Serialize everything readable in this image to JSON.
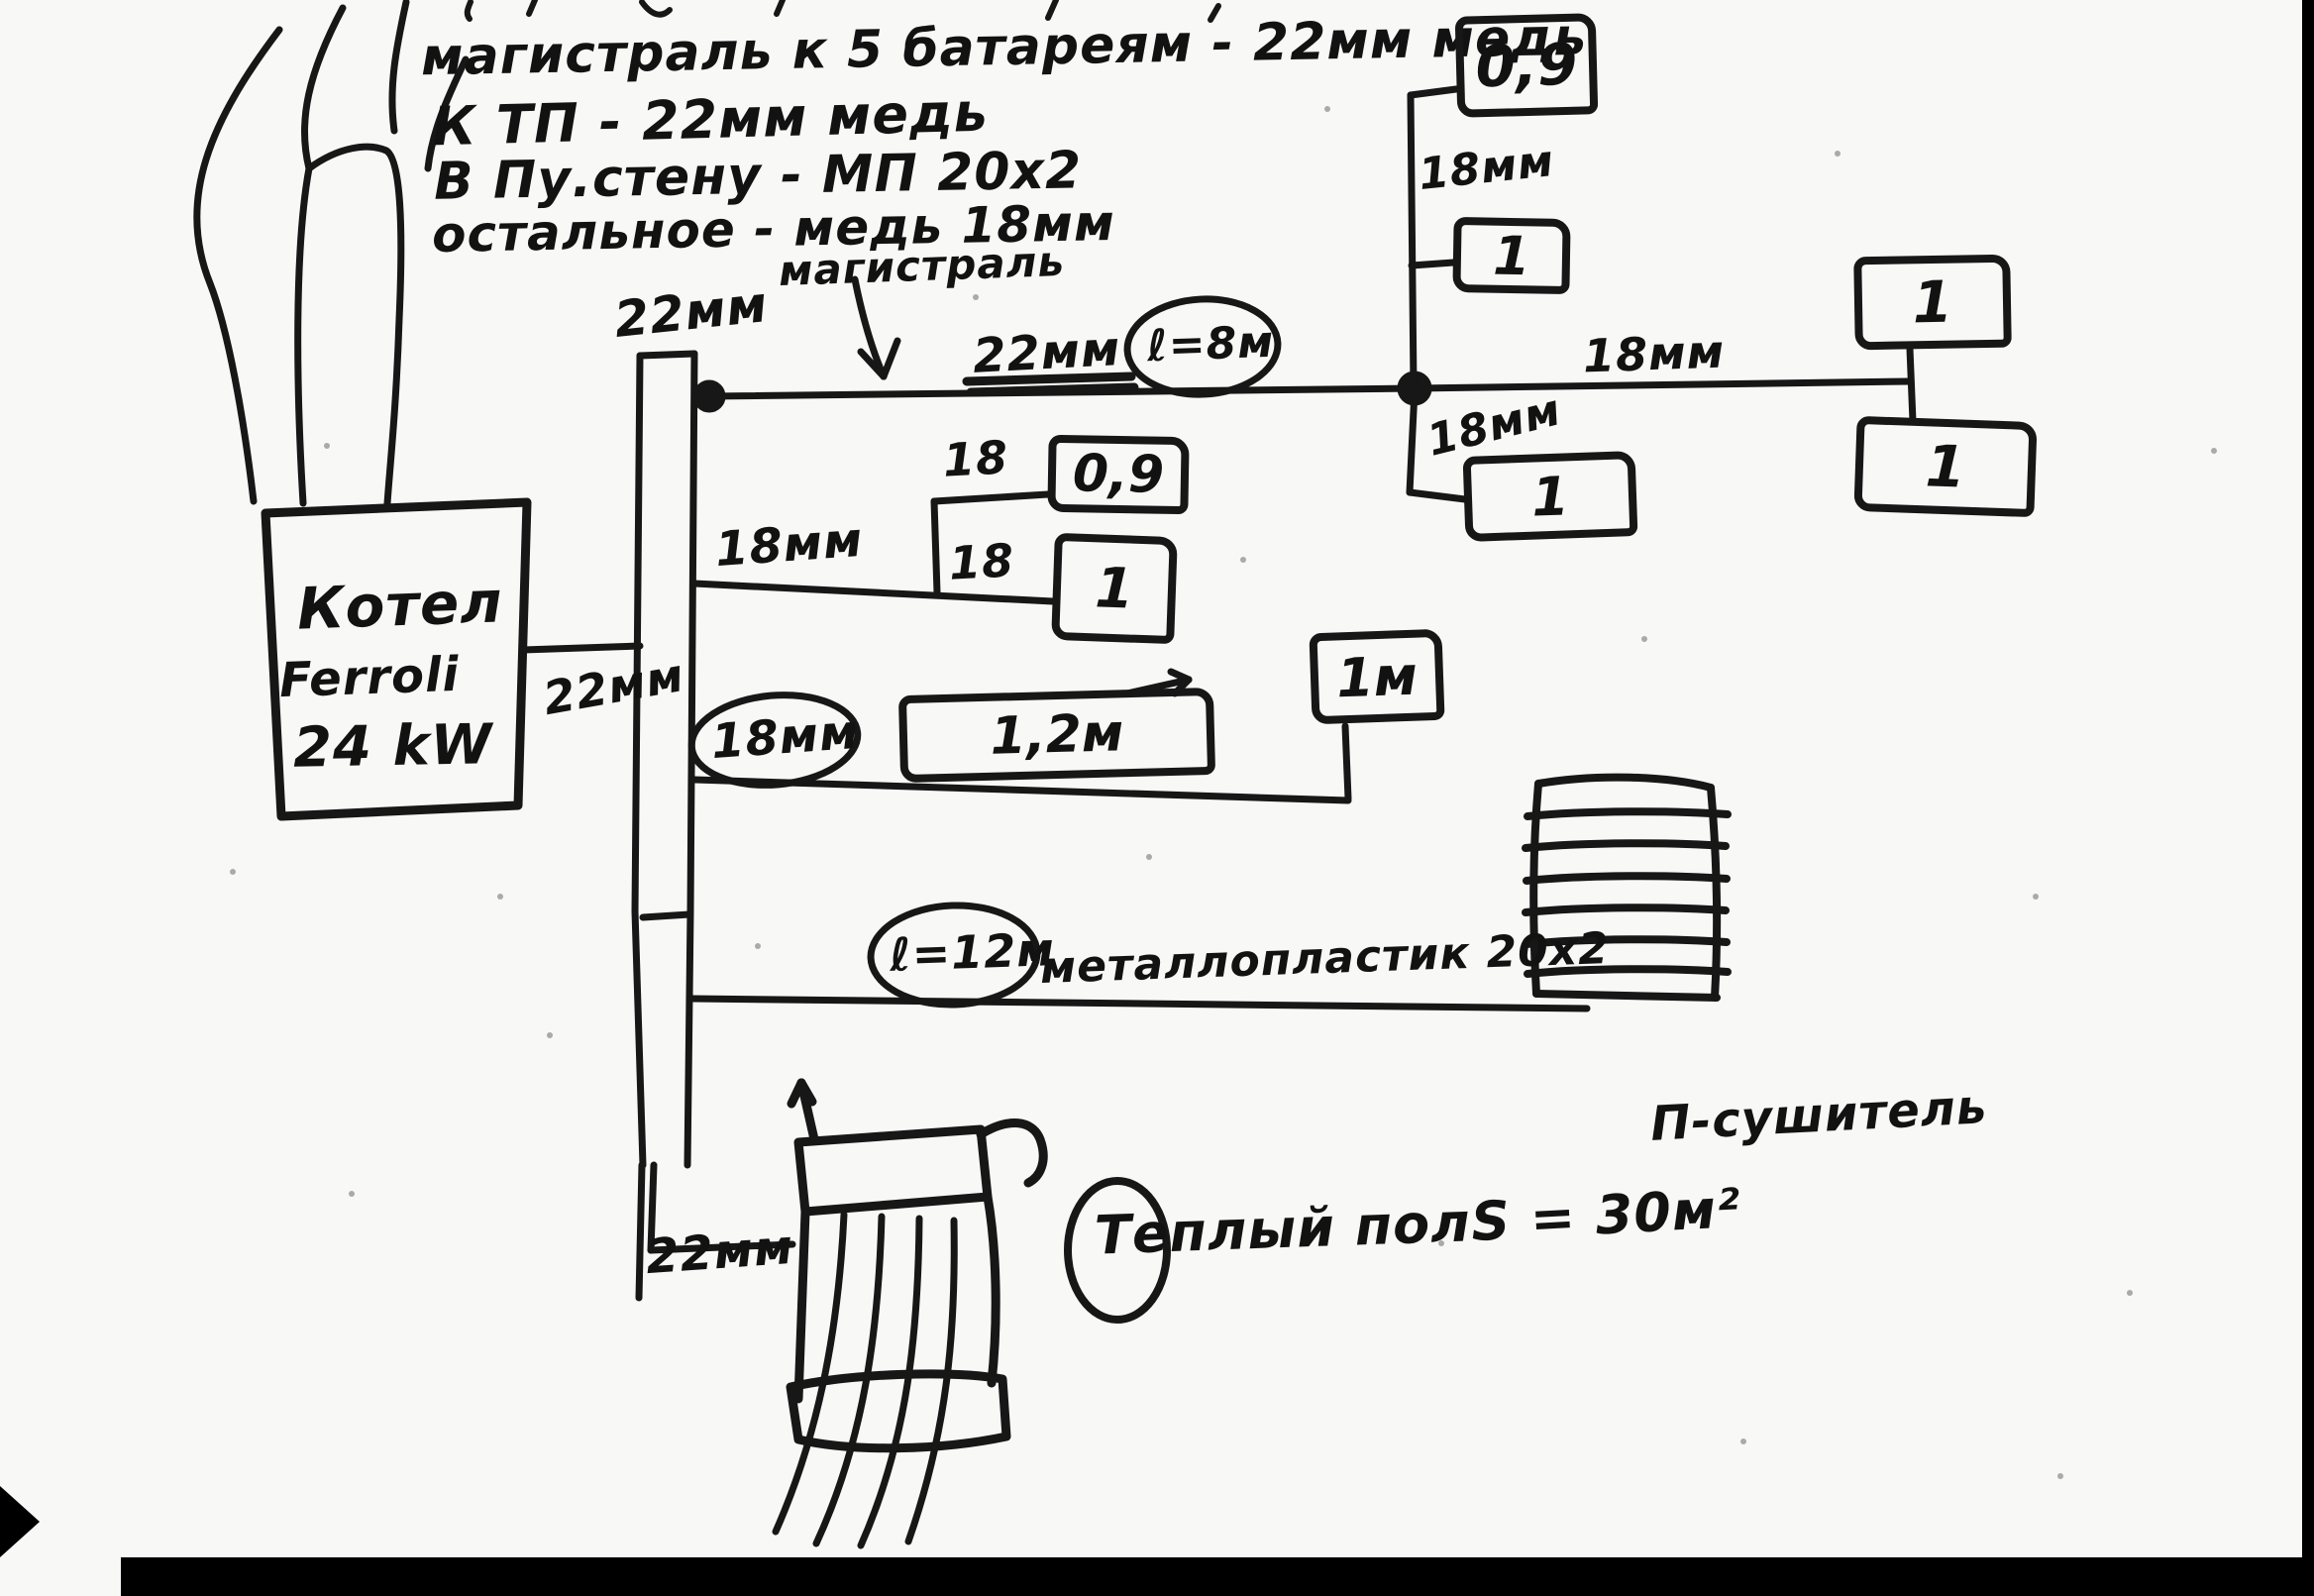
{
  "notes": {
    "line1": "магистраль к 5 батареям - 22мм медь",
    "line2": "К ТП - 22мм медь",
    "line3": "В Пу.стену - МП 20х2",
    "line4": "остальное - медь 18мм",
    "pointer_label": "магистраль"
  },
  "boiler": {
    "name": "Котел",
    "brand": "Ferroli",
    "power": "24 kW"
  },
  "pipes": {
    "riser_top": "22мм",
    "main_size": "22мм",
    "main_length": "ℓ=8м",
    "main_right": "18мм",
    "branch_top_right": "18мм",
    "branch_below_junction": "18мм",
    "branch_middle": "18мм",
    "branch_middle_sub1": "18",
    "branch_middle_sub2": "18",
    "branch_lower": "18мм",
    "boiler_connection": "22мм",
    "floor_connection": "22мм",
    "floor_line_length": "ℓ=12м",
    "floor_line_material": "металлопластик 20х2"
  },
  "radiators": [
    {
      "value": "0,9"
    },
    {
      "value": "1"
    },
    {
      "value": "1"
    },
    {
      "value": "1"
    },
    {
      "value": "1"
    },
    {
      "value": "0,9"
    },
    {
      "value": "1"
    },
    {
      "value": "1,2м"
    },
    {
      "value": "1м"
    }
  ],
  "towel_dryer": {
    "label": "П-сушитель"
  },
  "floor_heating": {
    "label": "Теплый пол",
    "area": "S = 30м²"
  }
}
